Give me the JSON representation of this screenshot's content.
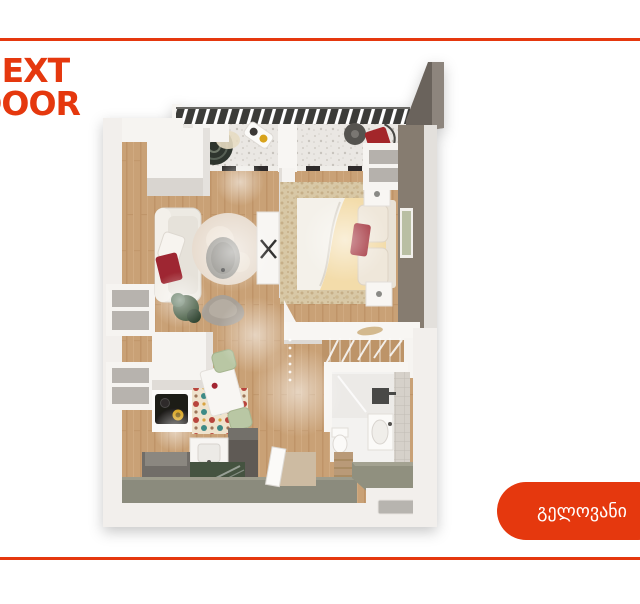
{
  "brand": {
    "name": "NEXT DOOR",
    "logo_line1": "NEXT",
    "logo_line2": "DOOR",
    "color": "#E5380E"
  },
  "frame": {
    "top_rule_color": "#E5380E",
    "bottom_rule_color": "#E5380E"
  },
  "location_badge": {
    "label": "გელოვანი",
    "background": "#E5380E",
    "text_color": "#FFFFFF"
  },
  "floorplan": {
    "kind": "3d-top-down-apartment-plan",
    "rooms": [
      "balcony",
      "living-room",
      "bedroom",
      "kitchen",
      "bathroom",
      "hallway",
      "stairs"
    ],
    "palette": {
      "wood_floor": "#C9A176",
      "balcony_floor": "#EAE7E3",
      "railing": "#3B3A38",
      "bedroom_wall": "#867B70",
      "entrance_floor": "#8B8B7D",
      "accent_red_furniture": "#9E2832"
    }
  }
}
